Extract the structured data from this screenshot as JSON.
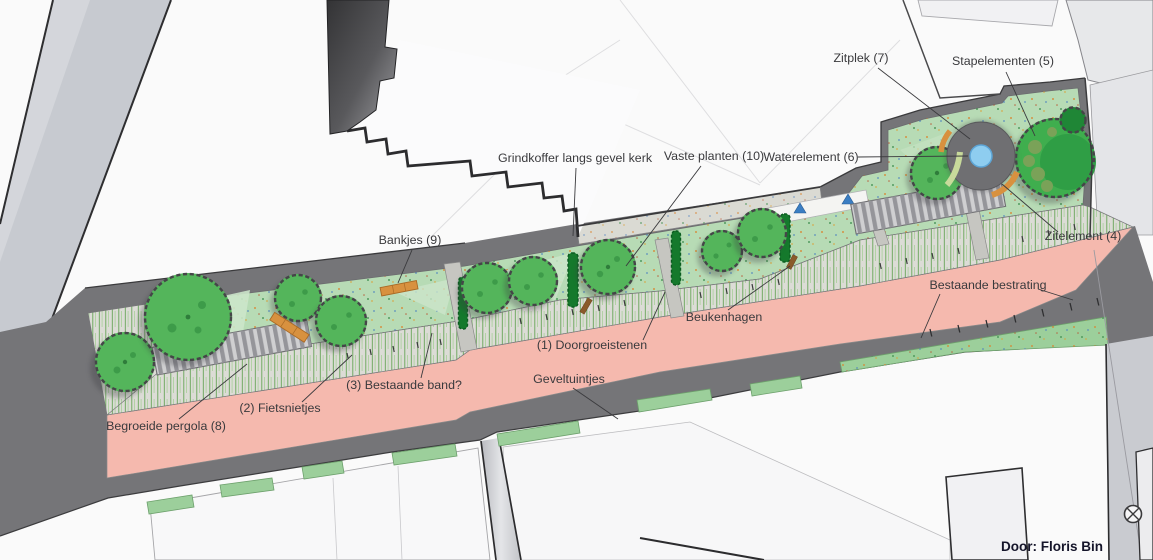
{
  "plan": {
    "credit": "Door: Floris Bin",
    "labels": {
      "zitplek": "Zitplek (7)",
      "stapelementen": "Stapelementen (5)",
      "grindkoffer": "Grindkoffer langs gevel kerk",
      "vaste_planten": "Vaste planten (10)",
      "waterelement": "Waterelement (6)",
      "zitelement": "Zitelement (4)",
      "bankjes": "Bankjes (9)",
      "bestaande_bestrating": "Bestaande bestrating",
      "beukenhagen": "Beukenhagen",
      "doorgroeistenen": "(1) Doorgroeistenen",
      "fietsnietjes": "(2) Fietsnietjes",
      "bestaande_band": "(3) Bestaande band?",
      "geveltuintjes": "Geveltuintjes",
      "begroeide_pergola": "Begroeide pergola (8)"
    },
    "colors": {
      "paving_pink": "#f5b9ae",
      "greenspace": "#b7dbb5",
      "tree_green": "#54b55b",
      "tree_dark": "#3fae4e",
      "water_blue": "#8ecdf0",
      "plaza_gray": "#6f6f72",
      "sidewalk_gray": "#757578",
      "accent_orange": "#d8913f",
      "hedge_green": "#15792c",
      "hatch_base": "#dcdcd6",
      "street_gray": "#c7cad0"
    }
  }
}
